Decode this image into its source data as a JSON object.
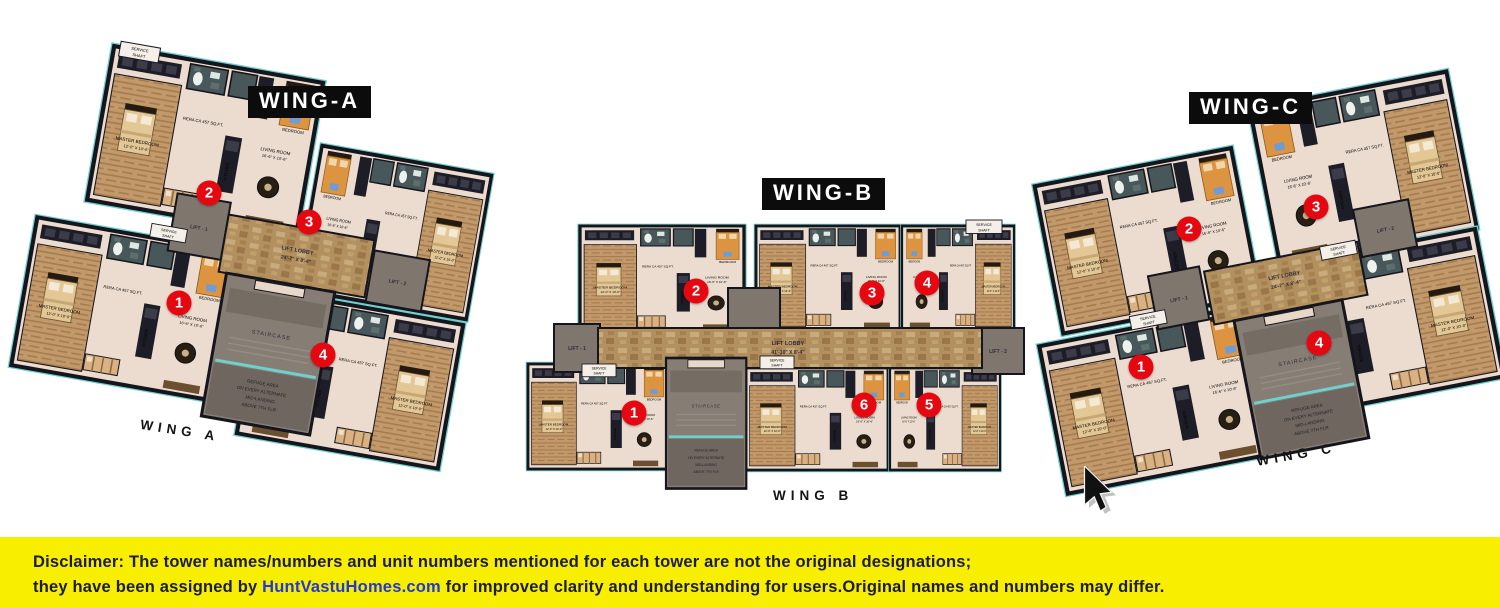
{
  "wing_a": {
    "title": "WING-A",
    "caption": "WING A",
    "lobby_label": "LIFT LOBBY",
    "lobby_dim": "24'-7\" X 8'-4\"",
    "markers": [
      "1",
      "2",
      "3",
      "4"
    ]
  },
  "wing_b": {
    "title": "WING-B",
    "caption": "WING B",
    "lobby_label": "LIFT LOBBY",
    "lobby_dim": "41'-10\" X 8'-4\"",
    "markers": [
      "1",
      "2",
      "3",
      "4",
      "5",
      "6"
    ]
  },
  "wing_c": {
    "title": "WING-C",
    "caption": "WING C",
    "lobby_label": "LIFT LOBBY",
    "lobby_dim": "24'-7\" X 8'-4\"",
    "markers": [
      "1",
      "2",
      "3",
      "4"
    ]
  },
  "core": {
    "lift1": "LIFT - 1",
    "lift2": "LIFT - 2",
    "staircase": "STAIRCASE",
    "refuge_l1": "REFUGE AREA",
    "refuge_l2": "ON EVERY ALTERNATE",
    "refuge_l3": "MID-LANDING",
    "refuge_l4": "ABOVE 7TH FLR",
    "service_l1": "SERVICE",
    "service_l2": "SHAFT"
  },
  "rooms": {
    "master": "MASTER BEDROOM",
    "master_dim": "12'-0\" X 10'-0\"",
    "bedroom": "BEDROOM",
    "bedroom_dim": "10'-0\" X 9'-6\"",
    "living": "LIVING ROOM",
    "living_dim": "16'-6\" X 10'-6\"",
    "kitchen": "KITCHEN",
    "rera": "RERA CA 457 SQ.FT."
  },
  "colors": {
    "marker_red": "#e50811",
    "teal_accent": "#6fd0cc",
    "disclaimer_yellow": "#f7ee00",
    "link_blue": "#2337d4"
  },
  "disclaimer": {
    "label": "Disclaimer:",
    "text1": " The tower names/numbers and unit numbers mentioned for each tower are not the original designations;",
    "text2_pre": "they have been assigned by ",
    "link": "HuntVastuHomes.com",
    "text2_post": " for improved clarity and understanding for users.Original names and numbers may differ."
  }
}
